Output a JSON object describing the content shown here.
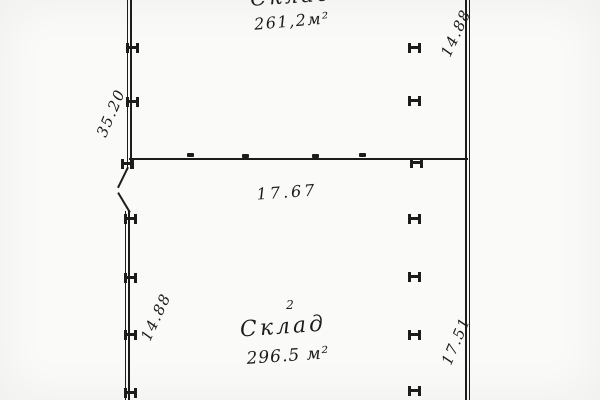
{
  "plan": {
    "colors": {
      "ink": "#1c1c1c",
      "paper": "#fafaf8"
    },
    "rooms": [
      {
        "label": "Склад",
        "number": "",
        "area": "261,2м²"
      },
      {
        "label": "Склад",
        "number": "2",
        "area": "296.5 м²"
      }
    ],
    "dimensions": {
      "left_upper": "35.20",
      "top_right": "14.88",
      "divider": "17.67",
      "left_lower": "14.88",
      "right_lower": "17.51"
    }
  }
}
